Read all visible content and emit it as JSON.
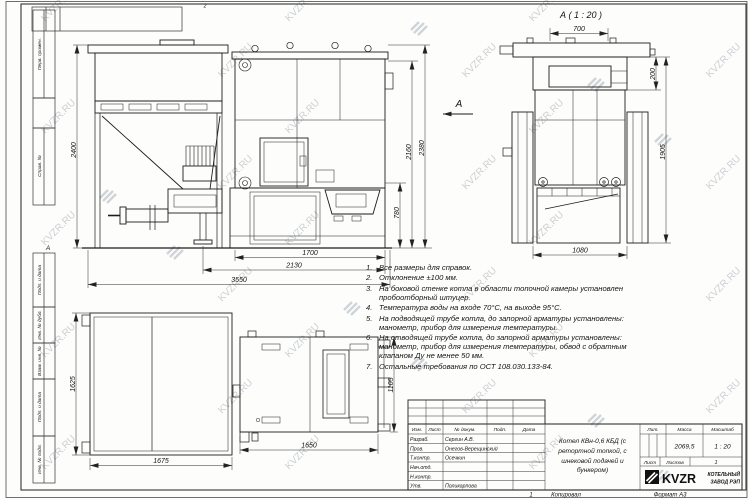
{
  "watermark": {
    "text": "KVZR.RU"
  },
  "frame": {
    "zone_letter_left": "А",
    "zone_number_top": "2",
    "margin_labels": [
      "Перв. примен.",
      "Справ. №",
      "Подп. и дата",
      "Инв. № дубл.",
      "Взам. инв. №",
      "Подп. и дата",
      "Инв. № подл."
    ]
  },
  "views": {
    "view_arrow_label": "А",
    "rear_label": "А ( 1 : 20 )",
    "front": {
      "dims": {
        "h_total": "2400",
        "h_boiler_outer": "2380",
        "h_boiler": "2160",
        "h_base": "780",
        "w_base": "1700",
        "w_mid": "2130",
        "w_total": "3550"
      }
    },
    "rear": {
      "dims": {
        "w_top": "700",
        "h_top": "200",
        "h_total": "1905",
        "w_base": "1080"
      }
    },
    "plan": {
      "dims": {
        "bunker_h": "1625",
        "bunker_w": "1675",
        "boiler_w": "1650",
        "boiler_h": "1105"
      }
    }
  },
  "notes": {
    "items": [
      {
        "n": "1.",
        "t": "Все размеры для справок."
      },
      {
        "n": "2.",
        "t": "Отклонение ±100 мм."
      },
      {
        "n": "3.",
        "t": "На боковой стенке котла в области топочной камеры установлен пробоотборный штуцер."
      },
      {
        "n": "4.",
        "t": "Температура воды на входе 70°С, на выходе 95°С."
      },
      {
        "n": "5.",
        "t": "На подводящей трубе котла, до запорной арматуры установлены: манометр, прибор для измерения температуры."
      },
      {
        "n": "6.",
        "t": "На отводящей трубе котла, до запорной арматуры установлены: манометр, прибор для измерения температуры, обвод с обратным клапаном Ду не менее 50 мм."
      },
      {
        "n": "7.",
        "t": "Остальные требования по ОСТ 108.030.133-84."
      }
    ]
  },
  "title_block": {
    "header_cols": [
      "Изм.",
      "Лист",
      "№ докум.",
      "Подп.",
      "Дата"
    ],
    "rows": [
      {
        "role": "Разраб.",
        "name": "Сергин А.В."
      },
      {
        "role": "Пров.",
        "name": "Онегов-Верещинский"
      },
      {
        "role": "Т.контр.",
        "name": "Осечкин"
      },
      {
        "role": "Нач.отд.",
        "name": ""
      },
      {
        "role": "Н.контр.",
        "name": ""
      },
      {
        "role": "Утв.",
        "name": "Поликарпова"
      }
    ],
    "title": "Котел КВн-0,6 КБД (с ретортной топкой, с шнековой подачей и бункером)",
    "lit_label": "Лит.",
    "mass_label": "Масса",
    "scale_label": "Масштаб",
    "mass": "2069,5",
    "scale": "1 : 20",
    "sheet_label": "Лист",
    "sheets_label": "Листов",
    "sheets_value": "1",
    "brand": "KVZR",
    "company_line1": "КОТЕЛЬНЫЙ",
    "company_line2": "ЗАВОД РЭП",
    "footer_zone": "1",
    "footer_copy": "Копировал",
    "footer_format": "Формат А3"
  }
}
